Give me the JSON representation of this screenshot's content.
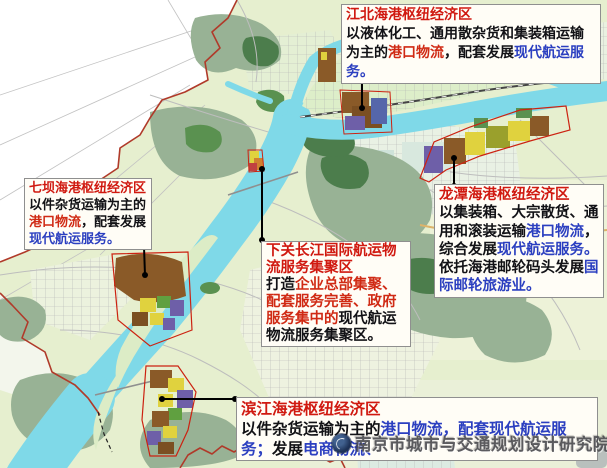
{
  "boxes": {
    "jiangbei": {
      "title": "江北海港枢纽经济区",
      "segs": [
        {
          "t": "以液体化工、通用散杂货和集装箱运输为主的",
          "c": "black"
        },
        {
          "t": "港口物流",
          "c": "red"
        },
        {
          "t": "，配套发展",
          "c": "black"
        },
        {
          "t": "现代航运服务。",
          "c": "blue"
        }
      ]
    },
    "qiba": {
      "title": "七坝海港枢纽经济区",
      "segs": [
        {
          "t": "以件杂货运输为主的",
          "c": "black"
        },
        {
          "t": "港口物流",
          "c": "red"
        },
        {
          "t": "，配套发展",
          "c": "black"
        },
        {
          "t": "现代航运服务。",
          "c": "blue"
        }
      ]
    },
    "xiaguan": {
      "title": "下关长江国际航运物流服务集聚区",
      "segs": [
        {
          "t": "打造",
          "c": "black"
        },
        {
          "t": "企业总部集聚、配套服务完善、政府服务集中的",
          "c": "red"
        },
        {
          "t": "现代航运物流服务集聚区。",
          "c": "black"
        }
      ]
    },
    "longtan": {
      "title": "龙潭海港枢纽经济区",
      "segs": [
        {
          "t": "以集装箱、大宗散货、通用和滚装运输",
          "c": "black"
        },
        {
          "t": "港口物流",
          "c": "blue"
        },
        {
          "t": "，综合发展",
          "c": "black"
        },
        {
          "t": "现代航运服务。",
          "c": "blue"
        },
        {
          "t": "依托海港邮轮码头发展",
          "c": "black"
        },
        {
          "t": "国际邮轮旅游业。",
          "c": "blue"
        }
      ]
    },
    "binjiang": {
      "title": "滨江海港枢纽经济区",
      "segs": [
        {
          "t": "以件杂货运输为主的",
          "c": "black"
        },
        {
          "t": "港口物流，配套现代航运服务；",
          "c": "blue"
        },
        {
          "t": "发展",
          "c": "black"
        },
        {
          "t": "电商物流、",
          "c": "blue"
        }
      ]
    }
  },
  "watermark": {
    "logo": "institute-seal",
    "text": "南京市城市与交通规划设计研究院"
  },
  "colors": {
    "title_red": "#d01910",
    "inline_red": "#d02a14",
    "inline_blue": "#2b3fc0",
    "body_black": "#121216",
    "river": "#7fd9e8",
    "boundary_red": "#b03a2a",
    "plain_green": "#e6efcf",
    "hill_sage": "#98b295",
    "forest_green": "#4c7d4c",
    "zone_brown": "#8a5a28",
    "zone_yellow": "#e0d23e",
    "zone_purple": "#6e5fa8",
    "zone_olive": "#9aa02c"
  }
}
